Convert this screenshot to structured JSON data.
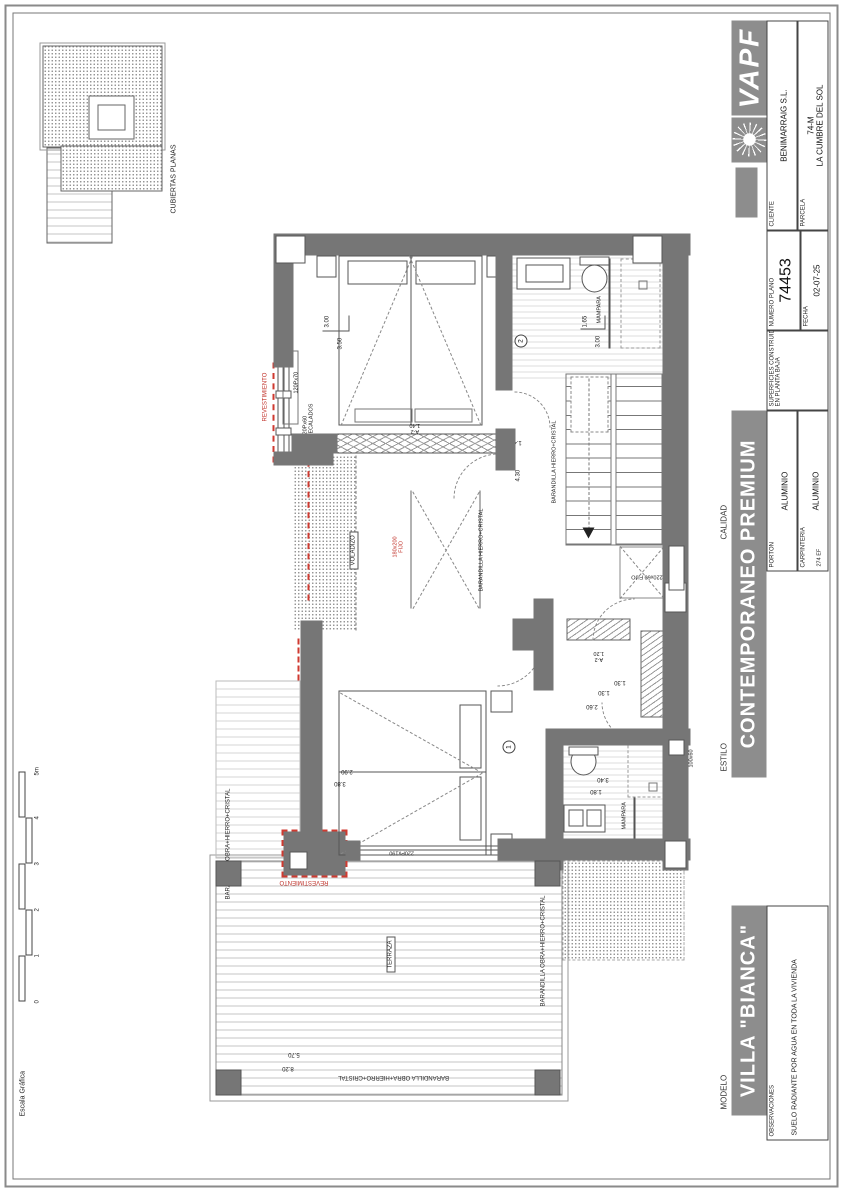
{
  "tb": {
    "logo": "VAPF",
    "cliente_label": "CLIENTE",
    "cliente_value": "BENIMARRAIG S.L.",
    "parcela_label": "PARCELA",
    "parcela_value1": "74-M",
    "parcela_value2": "LA CUMBRE DEL SOL",
    "numero_plano_label": "NUMERO PLANO",
    "numero_plano_value": "74453",
    "fecha_label": "FECHA",
    "fecha_value": "02-07-25",
    "superficies_label1": "SUPERFICIES CONSTRUIDAS",
    "superficies_label2": "EN PLANTA BAJA",
    "porton_label": "PORTON",
    "porton_value": "ALUMINIO",
    "carpinteria_label": "CARPINTERIA",
    "carpinteria_value": "ALUMINIO",
    "carpinteria_note": "274 EF",
    "calidad_label": "CALIDAD",
    "estilo_label": "ESTILO",
    "calidad_value": "CONTEMPORANEO PREMIUM",
    "modelo_label": "MODELO",
    "modelo_value": "VILLA \"BIANCA\"",
    "observaciones_label": "OBSERVACIONES",
    "observaciones_value": "SUELO RADIANTE POR AGUA EN TODA LA VIVIENDA"
  },
  "kp": {
    "caption": "CUBIERTAS PLANAS"
  },
  "sb": {
    "label": "Escala Gráfica",
    "ticks": [
      "0",
      "1",
      "2",
      "3",
      "4",
      "5m"
    ]
  },
  "plan": {
    "terraza": "TERRAZA",
    "voladizo": "VOLADIZO",
    "bar_obra": "BARANDILLA OBRA+HIERRO+CRISTAL",
    "bar_hc": "BARANDILLA HIERRO+CRISTAL",
    "mampara": "MAMPARA",
    "revest": "REVESTIMIENTO",
    "w12070": "120Px70",
    "w12060a": "120Px60",
    "w12060b": "DECALADOS",
    "w120100a": "120Px100",
    "w120100b": "FIJOS",
    "w180200a": "180x200",
    "w180200b": "FIJO",
    "w22060a": "220x60",
    "w22060b": "FIJO",
    "w220290": "220Px290",
    "w220190": "220Px190",
    "w10050": "100x50",
    "w10060": "100x60",
    "door_code": "A-2",
    "door_s140": "1.40",
    "door_s120": "1.20",
    "c1": "1",
    "c2": "2",
    "dims": {
      "d300": "3.00",
      "d350": "3.50",
      "d165": "1.65",
      "d300b": "3.00",
      "d430": "4.30",
      "d140": "1.40",
      "d130": "1.30",
      "d260": "2.60",
      "d130b": "1.30",
      "d380": "3.80",
      "d290": "2.90",
      "d180": "1.80",
      "d340": "3.40",
      "d820": "8.20",
      "d570": "5.70"
    }
  },
  "colors": {
    "wall": "#767676",
    "accent_red": "#cf3a30",
    "banner_gray": "#8d8d8d"
  }
}
